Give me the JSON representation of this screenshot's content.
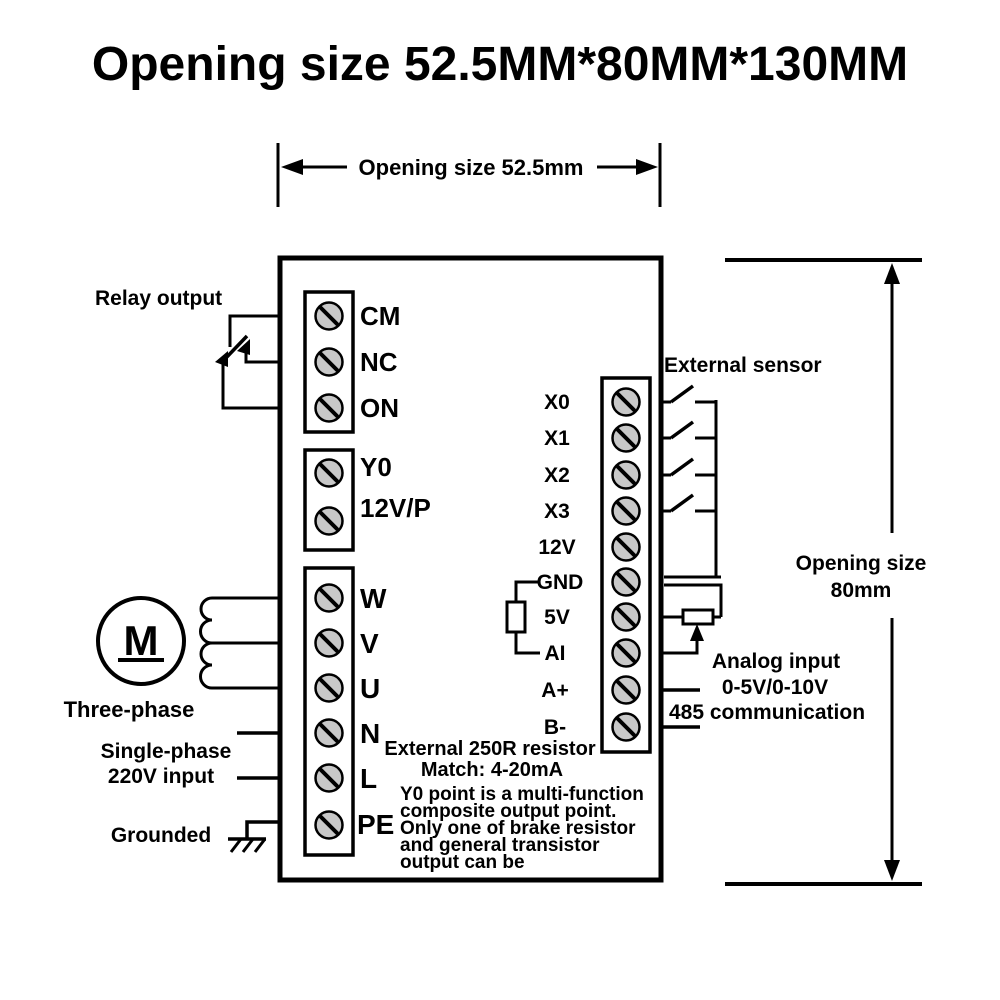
{
  "title": "Opening size 52.5MM*80MM*130MM",
  "dimensions": {
    "top": "Opening size 52.5mm",
    "right_line1": "Opening size",
    "right_line2": "80mm"
  },
  "labels": {
    "relay_output": "Relay output",
    "external_sensor": "External sensor",
    "three_phase": "Three-phase",
    "single_phase_line1": "Single-phase",
    "single_phase_line2": "220V input",
    "grounded": "Grounded",
    "analog_line1": "Analog input",
    "analog_line2": "0-5V/0-10V",
    "analog_line3": "485 communication",
    "motor_letter": "M"
  },
  "terminals": {
    "relay": [
      "CM",
      "NC",
      "ON"
    ],
    "output": [
      "Y0",
      "12V/P"
    ],
    "power": [
      "W",
      "V",
      "U",
      "N",
      "L",
      "PE"
    ],
    "io": [
      "X0",
      "X1",
      "X2",
      "X3",
      "12V",
      "GND",
      "5V",
      "AI",
      "A+",
      "B-"
    ]
  },
  "notes": {
    "resistor_line1": "External 250R resistor",
    "resistor_line2": "Match:  4-20mA",
    "y0_line1": "Y0 point is a multi-function",
    "y0_line2": "composite output point.",
    "y0_line3": "Only one of brake resistor",
    "y0_line4": "and general transistor",
    "y0_line5": "output can be"
  },
  "colors": {
    "line": "#000000",
    "screw_fill": "#c8c8c8",
    "background": "#ffffff"
  }
}
